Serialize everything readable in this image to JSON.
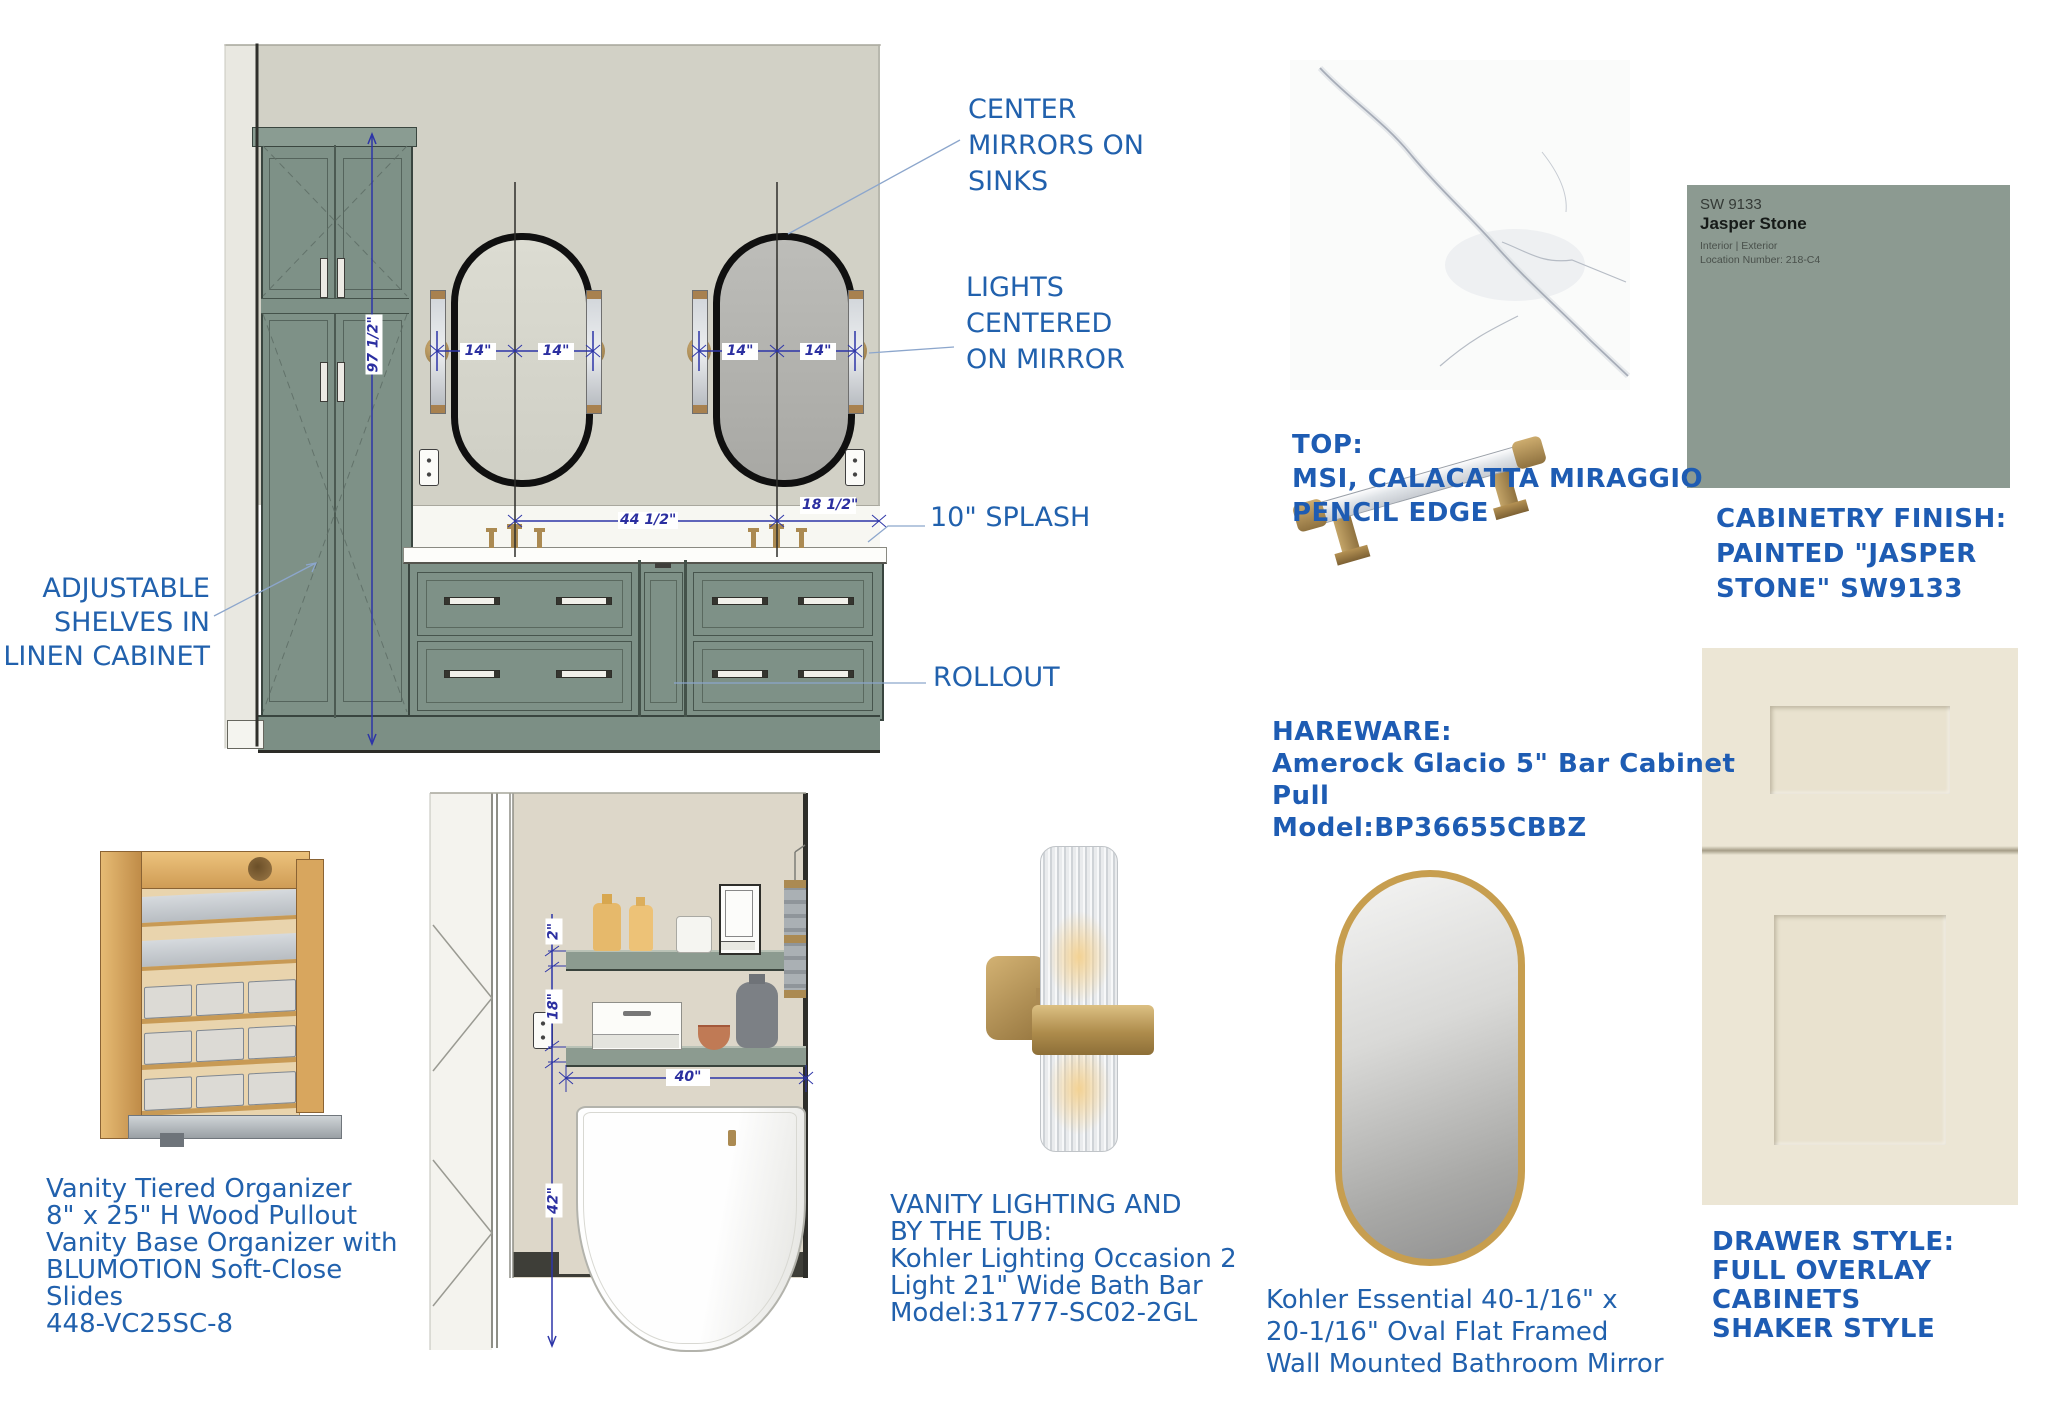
{
  "colors": {
    "annotation_blue": "#2161ad",
    "comic_blue": "#1e5cb3",
    "dimension_navy": "#2b2fa0",
    "cabinet_sage": "#7e9187",
    "paint_chip": "#8c9a91",
    "wall_gray": "#d2d1c6",
    "wall_beige": "#ddd7c9",
    "cream_cabinet": "#ece6d5",
    "brass": "#ab8a52",
    "mirror_gold": "#c79e4f"
  },
  "vanity_drawing": {
    "dimensions": {
      "cabinet_height": "97 1/2\"",
      "light_offset": "14\"",
      "sink_spacing": "44 1/2\"",
      "sink_to_wall": "18 1/2\""
    },
    "annotations": {
      "center_mirrors": [
        "CENTER",
        "MIRRORS ON",
        "SINKS"
      ],
      "lights_centered": [
        "LIGHTS",
        "CENTERED",
        "ON MIRROR"
      ],
      "splash": "10\" SPLASH",
      "rollout": "ROLLOUT",
      "adjustable_shelves": [
        "ADJUSTABLE",
        "SHELVES IN",
        "LINEN CABINET"
      ]
    }
  },
  "tub_drawing": {
    "dimensions": {
      "shelf_thickness": "2\"",
      "shelf_gap": "18\"",
      "shelf_width": "40\"",
      "shelf_height_above_floor": "42\""
    }
  },
  "countertop": {
    "note": [
      "TOP:",
      "MSI, CALACATTA MIRAGGIO",
      "PENCIL EDGE"
    ]
  },
  "cabinet_paint": {
    "chip": {
      "code": "SW 9133",
      "name": "Jasper Stone",
      "type": "Interior | Exterior",
      "location": "Location Number: 218-C4"
    },
    "note": [
      "CABINETRY FINISH:",
      "PAINTED \"JASPER",
      "STONE\" SW9133"
    ]
  },
  "hardware": {
    "note": [
      "HAREWARE:",
      "Amerock Glacio 5\" Bar Cabinet",
      "Pull",
      "Model:BP36655CBBZ"
    ]
  },
  "drawer_style": {
    "note": [
      "DRAWER STYLE:",
      "FULL OVERLAY",
      "CABINETS",
      "SHAKER STYLE"
    ]
  },
  "organizer": {
    "note": [
      "Vanity Tiered Organizer",
      "8\" x 25\" H Wood Pullout",
      "Vanity Base Organizer with",
      "BLUMOTION Soft-Close",
      "Slides",
      "448-VC25SC-8"
    ]
  },
  "vanity_lighting": {
    "note": [
      "VANITY LIGHTING AND",
      "BY THE TUB:",
      "Kohler Lighting Occasion 2",
      "Light 21\" Wide Bath Bar",
      "Model:31777-SC02-2GL"
    ]
  },
  "wall_mirror": {
    "note": [
      "Kohler Essential 40-1/16\" x",
      "20-1/16\" Oval Flat Framed",
      "Wall Mounted Bathroom Mirror"
    ]
  }
}
